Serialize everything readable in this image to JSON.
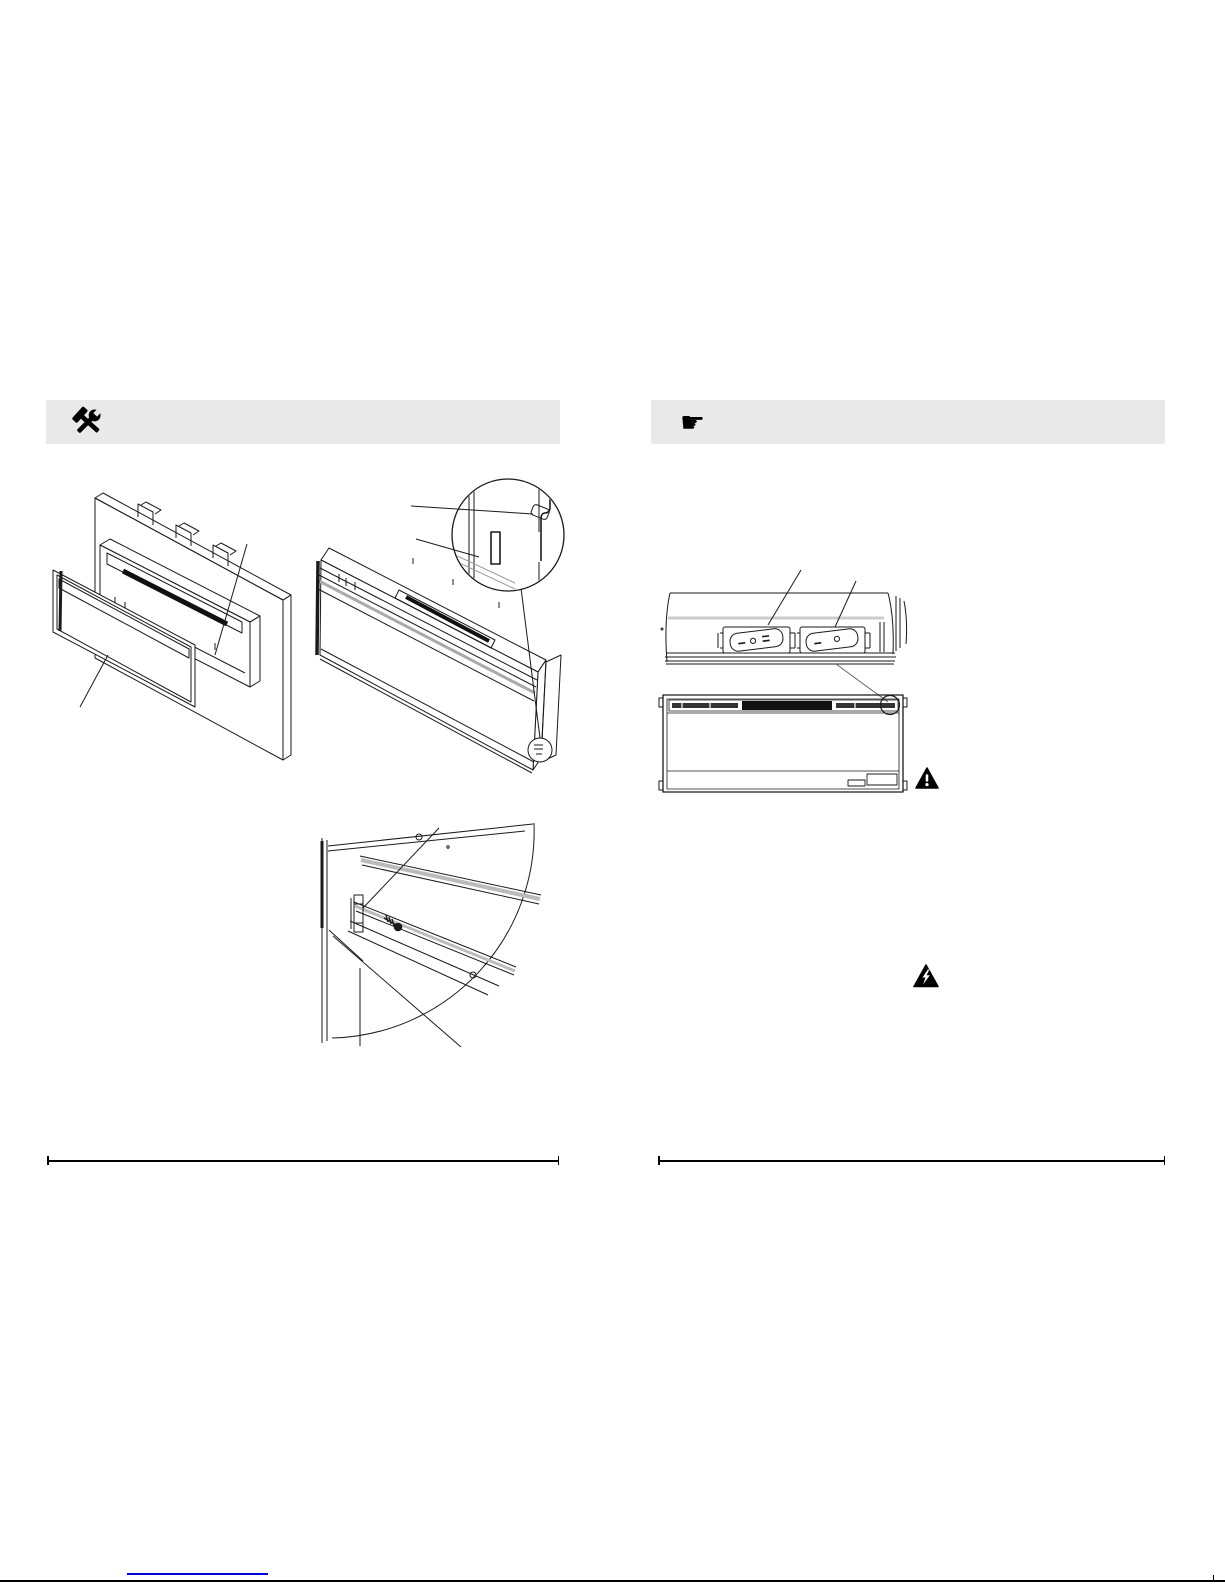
{
  "page": {
    "background": "#ffffff",
    "type": "installation-manual-page"
  },
  "header_bars": {
    "left": {
      "background": "#e9e9e9",
      "icon": "tools-icon"
    },
    "right": {
      "background": "#e9e9e9",
      "icon": "pointing-hand-icon",
      "glyph": "☛"
    }
  },
  "figures": {
    "fig1": "exploded-wall-frame-insert-and-glass-front",
    "fig2": "unit-angled-view-with-magnified-bracket-detail",
    "fig3": "quarter-fan-detail-bracket-screw",
    "fig4": "top-switch-panel-two-rocker-switches",
    "fig5": "front-view-with-switch-location-circle"
  },
  "switches": {
    "left_rocker_markings": [
      "I",
      "O",
      "II"
    ],
    "right_rocker_markings": [
      "I",
      "O"
    ]
  },
  "warning_icons": {
    "caution": "warning-exclamation-triangle-icon",
    "electrical": "warning-lightning-triangle-icon"
  },
  "footer": {
    "rule_color": "#000000",
    "link_underline_color": "#0000dd"
  }
}
